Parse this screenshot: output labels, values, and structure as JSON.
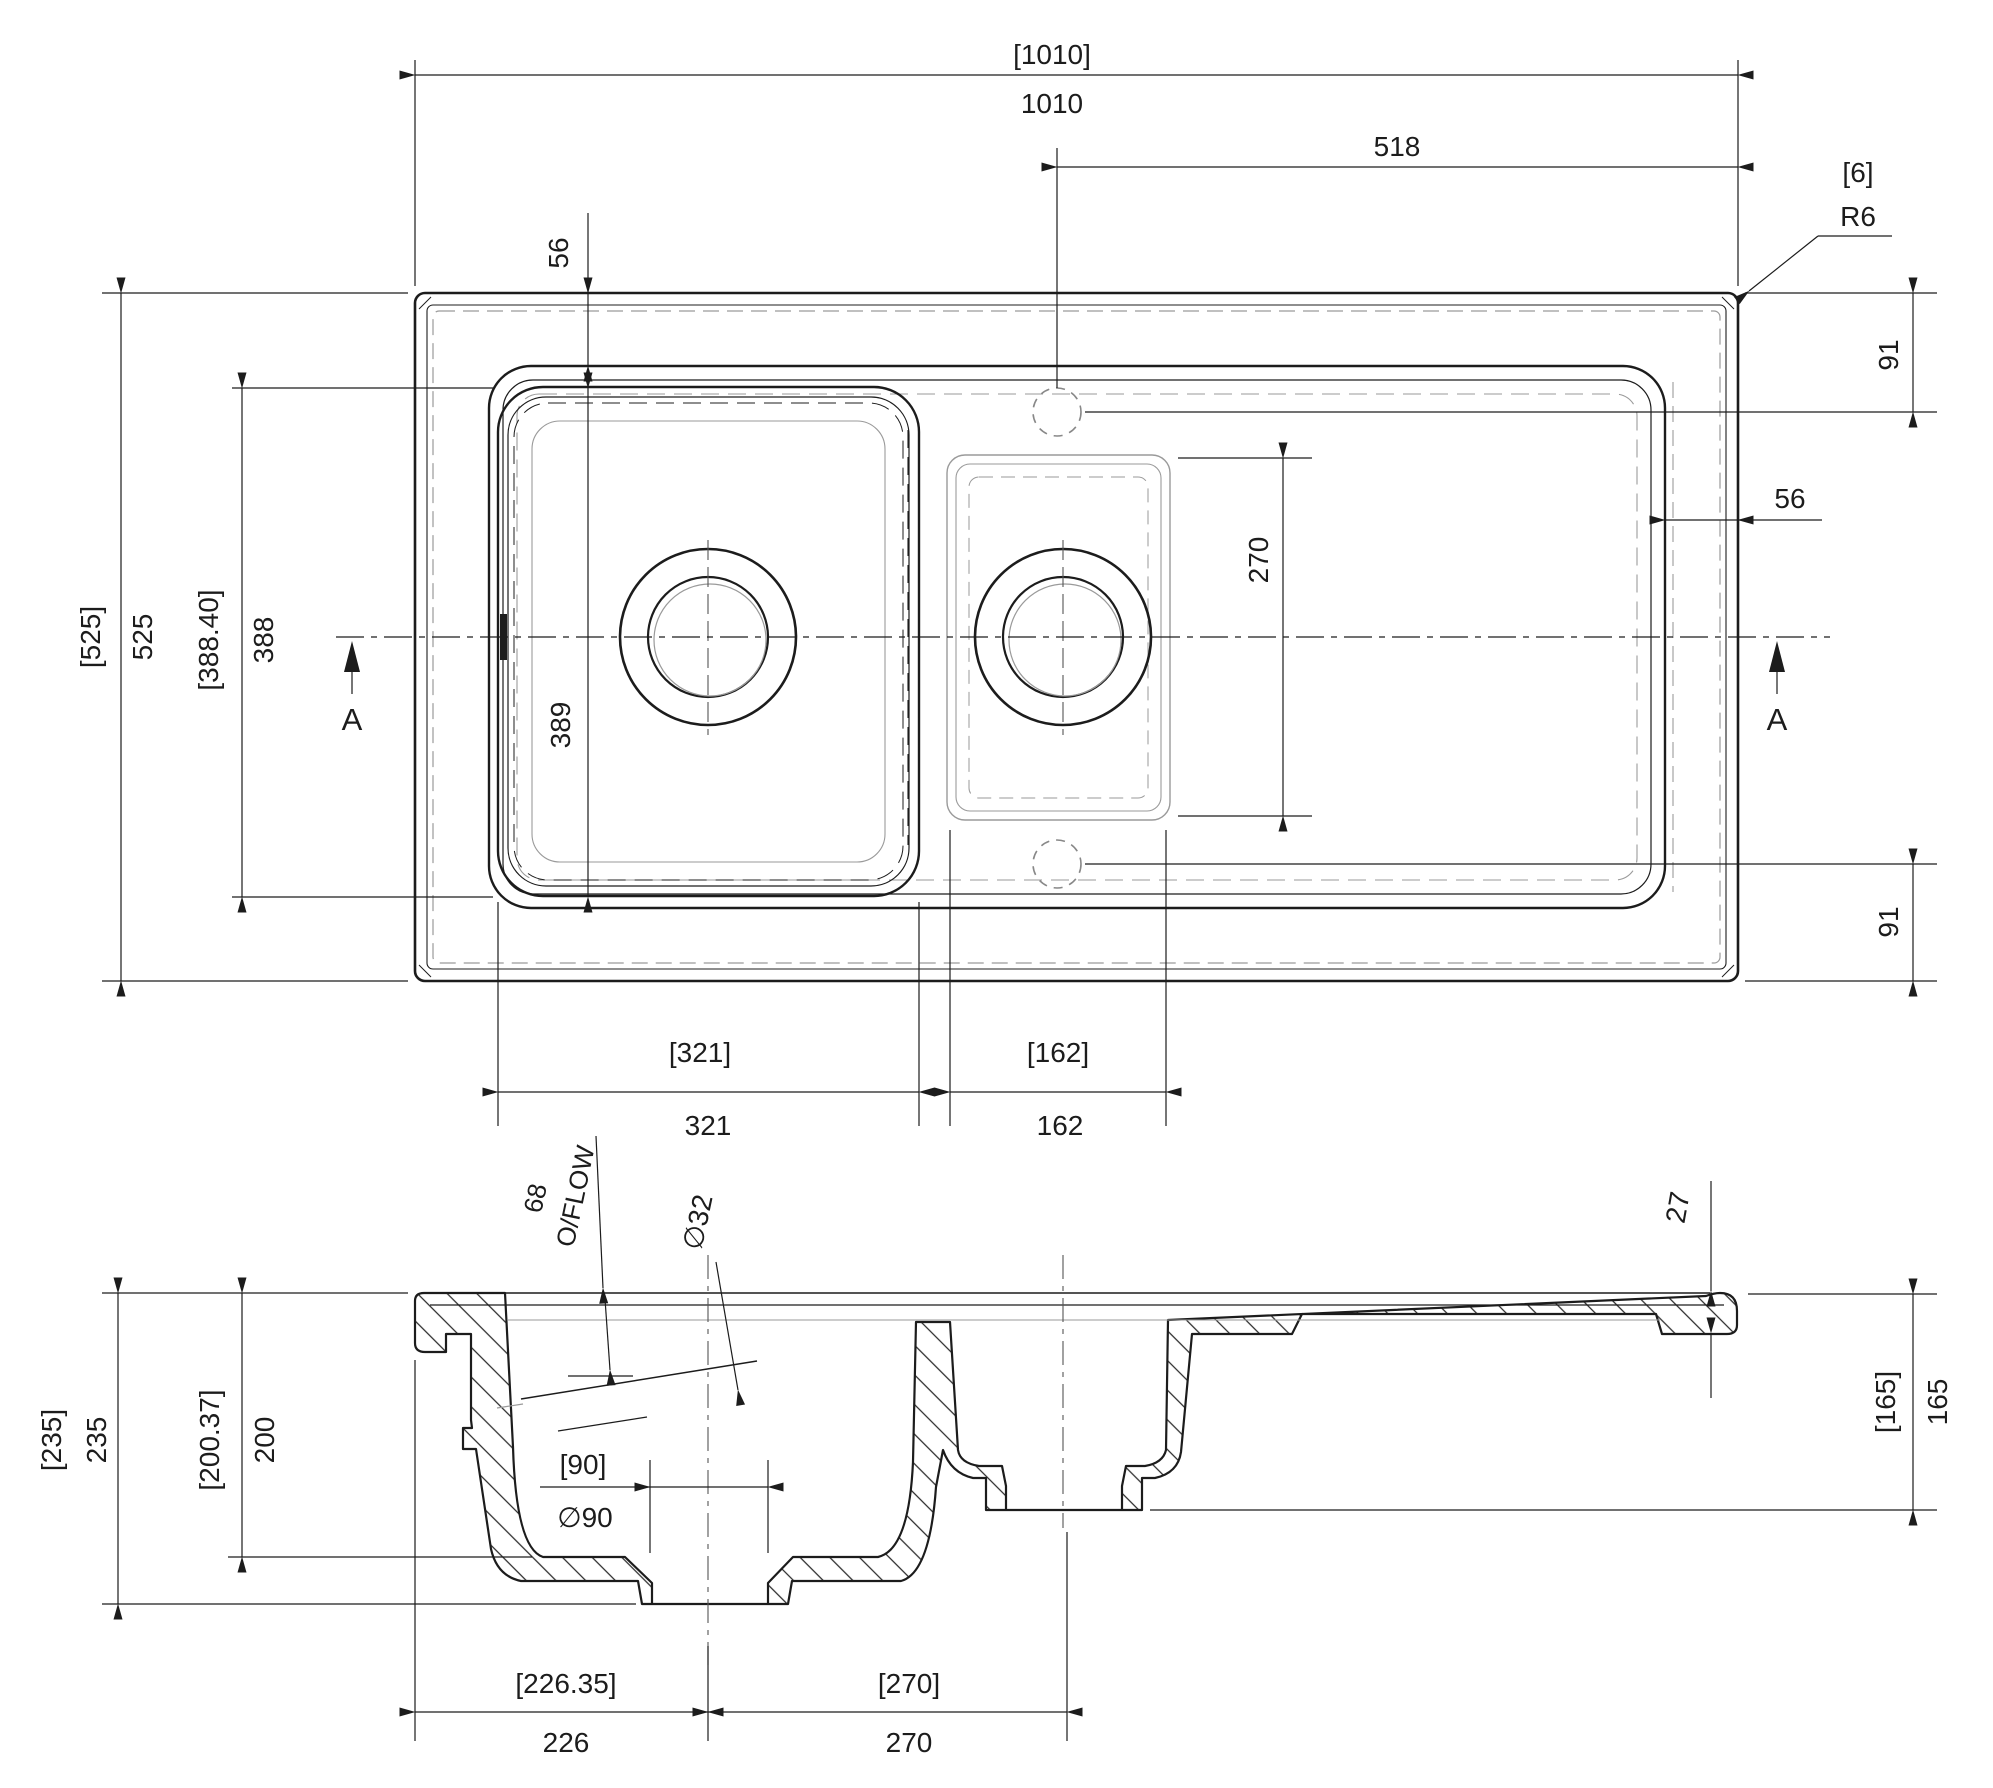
{
  "drawing": {
    "type": "technical-drawing",
    "subject": "inset kitchen sink, 1.5 bowl with drainer, plan and section A-A",
    "colors": {
      "line": "#1c1c1c",
      "hidden_grey": "#9a9a9a",
      "background": "#ffffff"
    },
    "plan": {
      "width_ref": "[1010]",
      "width": "1010",
      "tap_to_edge": "518",
      "corner_ref": "[6]",
      "corner_radius": "R6",
      "rim_inset_top": "56",
      "rim_inset_right": "56",
      "tap_offset_top": "91",
      "tap_offset_bottom": "91",
      "depth_ref": "[525]",
      "depth": "525",
      "bowl_len_ref": "[388.40]",
      "bowl_len": "388",
      "bowl_inner_len": "389",
      "half_bowl_len": "270",
      "bowl_width_ref": "[321]",
      "bowl_width": "321",
      "half_width_ref": "[162]",
      "half_width": "162",
      "section_mark_left": "A",
      "section_mark_right": "A"
    },
    "section": {
      "overflow_height": "68",
      "overflow_label": "O/FLOW",
      "overflow_dia": "∅32",
      "edge_thickness": "27",
      "overall_height_ref": "[235]",
      "overall_height": "235",
      "bowl_height_ref": "[200.37]",
      "bowl_height": "200",
      "waste_ref": "[90]",
      "waste_dia": "∅90",
      "half_height_ref": "[165]",
      "half_height": "165",
      "drain_center_ref": "[226.35]",
      "drain_center": "226",
      "drain_spacing_ref": "[270]",
      "drain_spacing": "270"
    }
  }
}
